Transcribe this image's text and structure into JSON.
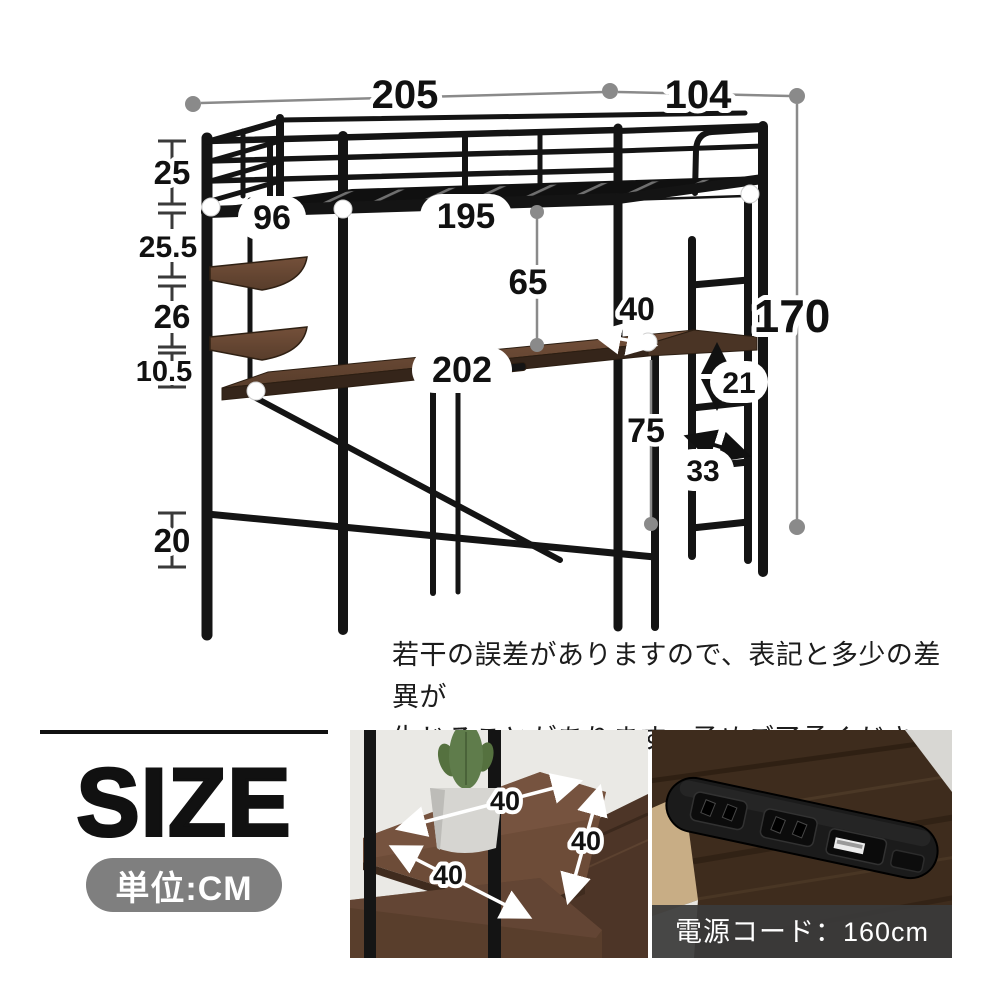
{
  "bed_diagram": {
    "dim_total_width": "205",
    "dim_total_depth": "104",
    "dim_total_height": "170",
    "dim_guard_rail_height": "25",
    "dim_upper_section": "25.5",
    "dim_shelf_section": "26",
    "dim_lower_section": "10.5",
    "dim_leg_bottom": "20",
    "dim_headboard_inner_width": "96",
    "dim_bed_inner_length": "195",
    "dim_under_bed_clearance": "65",
    "dim_desk_depth": "40",
    "dim_desk_length": "202",
    "dim_desk_height": "75",
    "dim_ladder_step": "21",
    "dim_ladder_width": "33"
  },
  "disclaimer": {
    "line1": "若干の誤差がありますので、表記と多少の差異が",
    "line2": "生じることがあります。予めご了承ください。"
  },
  "size_panel": {
    "title": "SIZE",
    "unit_badge": "単位:CM"
  },
  "shelf_photo": {
    "dim_a": "40",
    "dim_b": "40",
    "dim_c": "40"
  },
  "outlet_photo": {
    "caption": "電源コード：160cm"
  },
  "colors": {
    "metal_black": "#141414",
    "wood_brown": "#6b4a36",
    "dim_line_gray": "#8a8a8a",
    "badge_gray": "#7f7f7f",
    "caption_bar": "#3a3a3a"
  }
}
